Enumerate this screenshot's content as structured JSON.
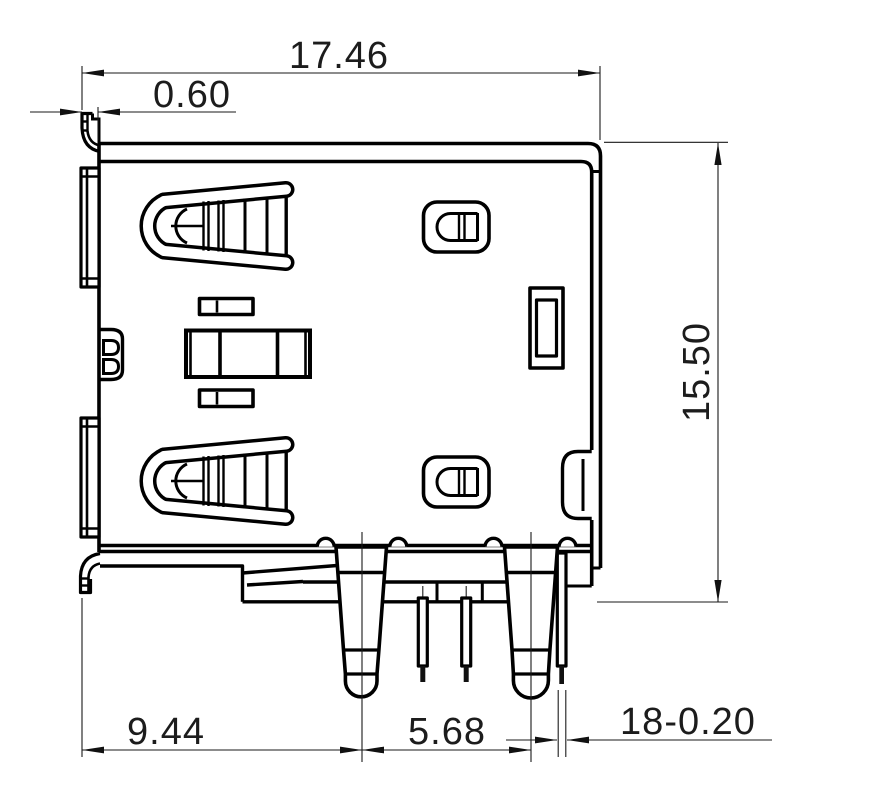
{
  "page": {
    "background": "#ffffff",
    "line_color": "#000000",
    "text_color": "#1c1c1c"
  },
  "drawing": {
    "kind": "technical-drawing",
    "view": "connector side view with dimension annotations",
    "dimensions": {
      "width_total": "17.46",
      "lip_thickness": "0.60",
      "height_total": "15.50",
      "edge_to_first_leg": "9.44",
      "leg_spacing": "5.68",
      "pin_note": "18-0.20"
    }
  }
}
